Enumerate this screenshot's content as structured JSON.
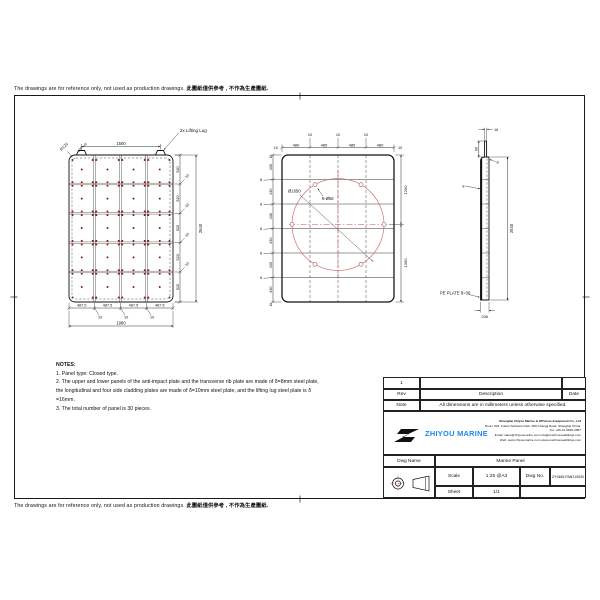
{
  "page": {
    "disclaimer_en": "The drawings are for reference only, not used as production drawings. ",
    "disclaimer_zh": "此圖紙僅供參考 , 不作為生產圖紙."
  },
  "notes": {
    "title": "NOTES:",
    "lines": [
      "1. Panel type: Closed type.",
      "2. The upper and lower panels of the anti-impact plate and the transverse rib plate are made of δ=8mm steel plate,",
      "the longitudinal and four side cladding plates are made of δ=10mm steel plate, and the lifting lug steel plate is δ",
      "=16mm.",
      "3. The total number of panel is 30 pieces."
    ]
  },
  "views": {
    "plan": {
      "lifting_lug_label": "2x Lifting Lug",
      "corner_radius": "R120",
      "lug_width": "40",
      "lug_offset": "240",
      "lug_spacing": "1500",
      "bottom_widths": [
        "487.5",
        "487.5",
        "487.5",
        "487.5"
      ],
      "bottom_gap": "10",
      "total_width": "1980",
      "side_heights": [
        "520",
        "520",
        "520",
        "520",
        "520"
      ],
      "side_gap": "10",
      "total_height": "2640",
      "grid": {
        "cols": 4,
        "rows": 5
      }
    },
    "rib": {
      "top_widths": [
        "480",
        "485",
        "485",
        "480"
      ],
      "top_gap": "10",
      "edge": "10",
      "row_heights": [
        "430",
        "430",
        "430",
        "430",
        "430",
        "430"
      ],
      "rib_thickness": "8",
      "circle_diameter": "Ø1650",
      "hole_callout": "6-Ø56",
      "upper_height": "1250",
      "lower_height": "1390"
    },
    "side": {
      "lug_thickness": "16",
      "lug_height": "90",
      "plate_top": "8",
      "plate_left": "8",
      "total_height": "2640",
      "thickness": "206",
      "pe_plate_label": "PE PLATE δ=30"
    }
  },
  "title_block": {
    "rev_no": "1",
    "headers": {
      "rev": "Rev",
      "description": "Description",
      "date": "Date"
    },
    "note_label": "Note",
    "note_text": "All dimensions are in millimeters unless otherwise specified.",
    "company": {
      "name": "ZHIYOU MARINE",
      "lines": [
        "Shanghai Zhiyou Marine & Offshore Equipment Co., Ltd",
        "Room 603, Fudan Software Park, 666 Changji Road, Shanghai China.",
        "Tel: +86-21-5666-2587",
        "Email: sales@zhiyoumarine.com  info@machineseafittings.com",
        "Web: www.zhiyoumarine.com  www.machineseafittings.com"
      ]
    },
    "dwg_name_label": "Dwg Name",
    "dwg_name": "Marine Panel",
    "scale_label": "Scale",
    "scale": "1:25 @A3",
    "dwg_no_label": "Dwg No.",
    "dwg_no": "ZY9469-PAN210630",
    "sheet_label": "Sheet",
    "sheet": "1/1"
  },
  "colors": {
    "accent_red": "#b22222",
    "logo_blue": "#1e88e5",
    "line": "#1a1a1a"
  }
}
